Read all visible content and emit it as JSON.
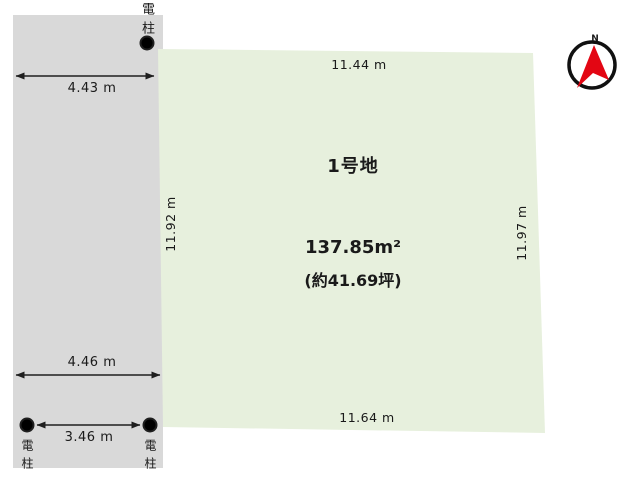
{
  "colors": {
    "road_fill": "#d9d9d9",
    "plot_fill": "#e7f0dd",
    "plot_border": "#4a6d30",
    "line": "#1f1f1f",
    "pole_fill": "#ffffff",
    "compass_ring": "#111111",
    "compass_needle": "#e30613"
  },
  "road": {
    "top_width_label": "4.43 m",
    "bottom_width_label": "4.46 m",
    "pole_span_label": "3.46 m",
    "pole_top_label": "電柱",
    "pole_bottom_left_label": "電柱",
    "pole_bottom_right_label": "電柱"
  },
  "plot": {
    "name": "1号地",
    "area_m2": "137.85m²",
    "area_tsubo": "(約41.69坪)",
    "side_top": "11.44 m",
    "side_left": "11.92 m",
    "side_right": "11.97 m",
    "side_bottom": "11.64 m"
  },
  "compass": {
    "north_label": "N"
  }
}
